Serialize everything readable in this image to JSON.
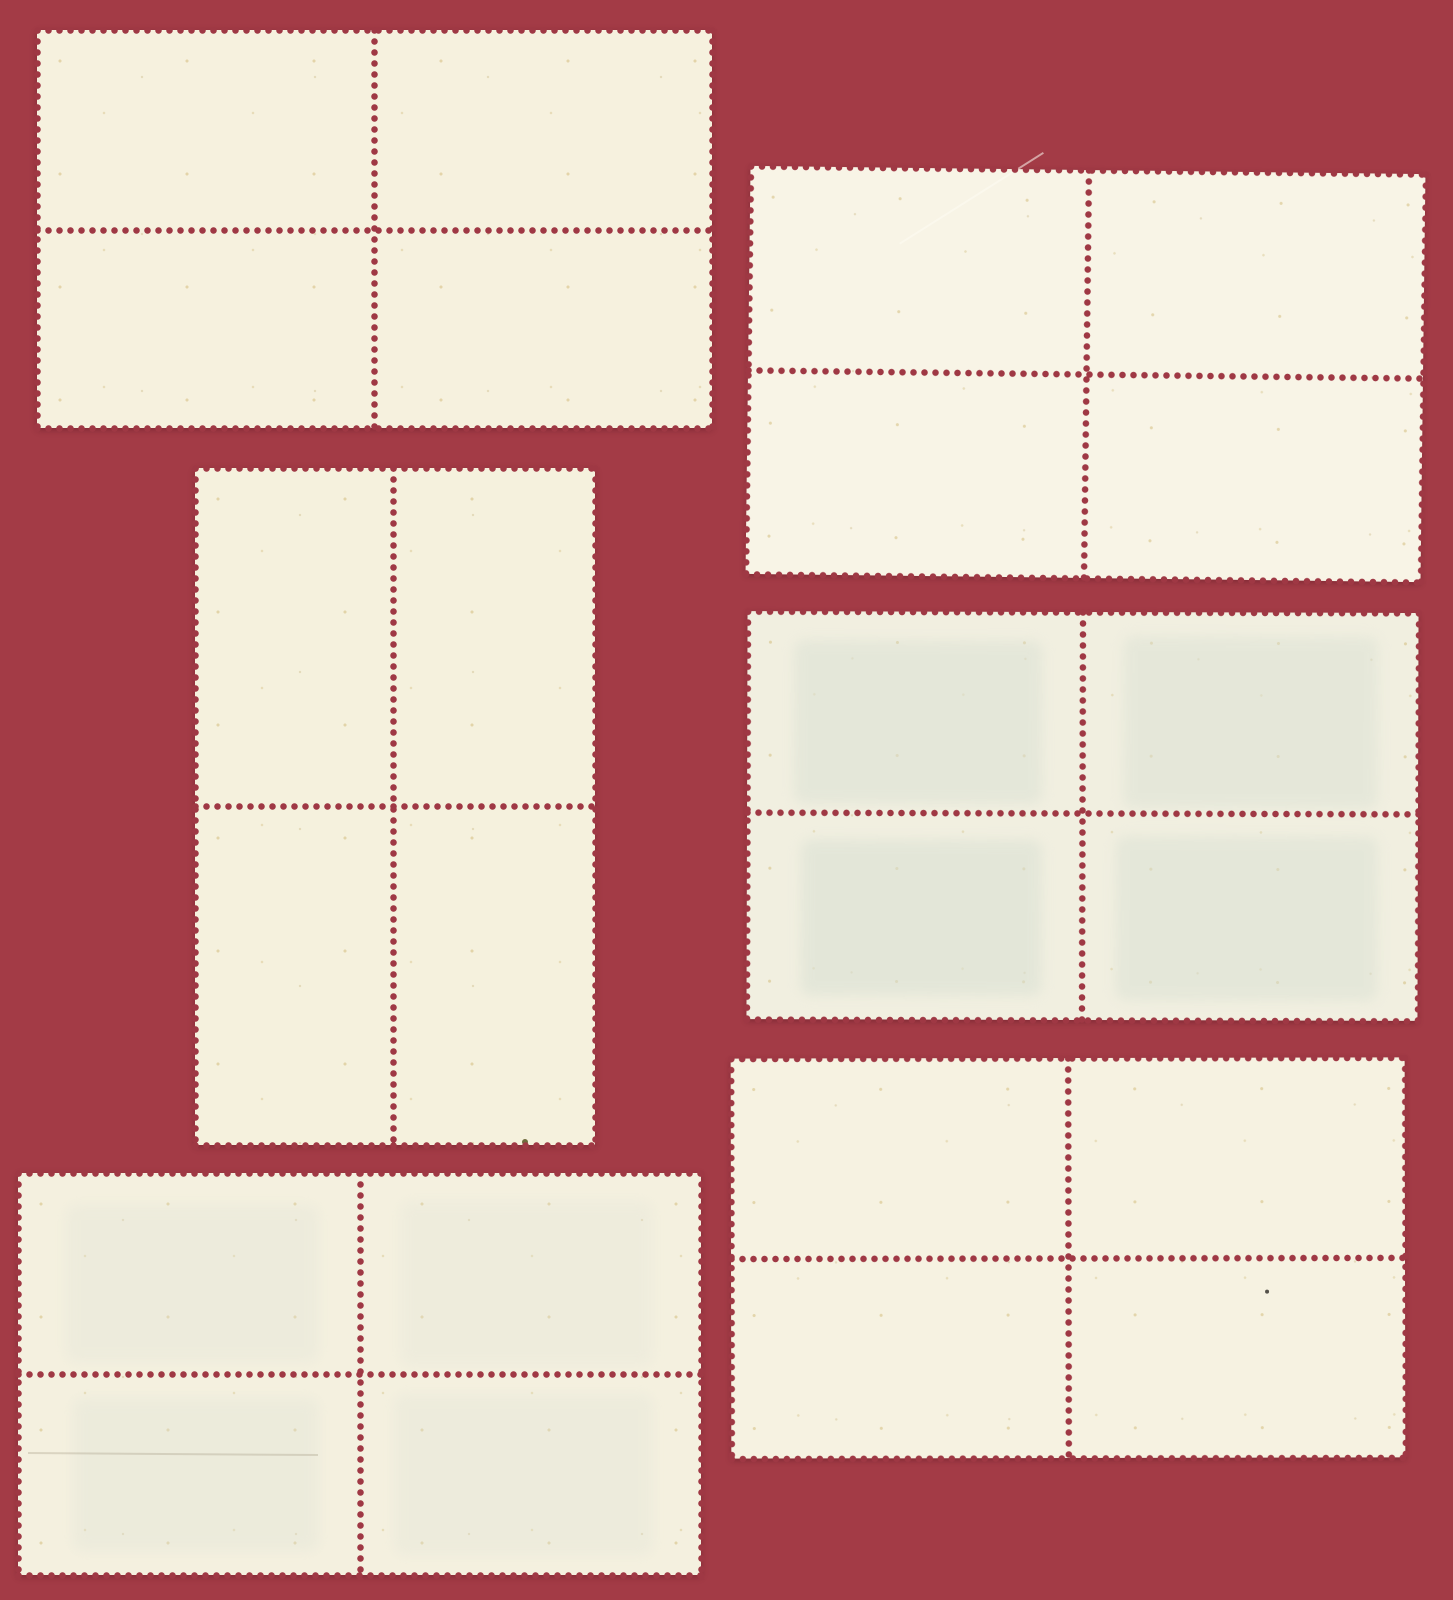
{
  "scene": {
    "type": "scanned-photo",
    "subject": "Six mint postage stamp blocks of four, shown from the blank gummed reverse side, arranged on a dark red album background",
    "canvas": {
      "width": 1453,
      "height": 1600
    },
    "colors": {
      "background_red": "#A33B46",
      "perforation_hole_red": "#9F3844",
      "shadow": "rgba(75,18,28,0.4)"
    },
    "perforation": {
      "pitch_px": 11,
      "hole_diameter_px": 7
    }
  },
  "blocks": [
    {
      "name": "stamp-block-top-left",
      "layout_hint": "horizontal block of four, 2x2",
      "x": 37,
      "y": 30,
      "width": 675,
      "height": 398,
      "vperf": 337,
      "hperf": 200,
      "rotation": 0,
      "paper_color": "#F6F1DE",
      "ghosts": [],
      "details": []
    },
    {
      "name": "stamp-block-top-right",
      "layout_hint": "horizontal block of four, 2x2, slightly tilted",
      "x": 748,
      "y": 170,
      "width": 675,
      "height": 408,
      "vperf": 338,
      "hperf": 204,
      "rotation": 0.7,
      "paper_color": "#F8F4E6",
      "ghosts": [],
      "details": [
        {
          "kind": "scratch",
          "left": 150,
          "top": 75,
          "length": 170,
          "angle": -33,
          "color": "rgba(253,251,243,0.55)"
        }
      ]
    },
    {
      "name": "stamp-block-middle-left",
      "layout_hint": "vertical block of four, 2x2 of upright stamps",
      "x": 195,
      "y": 468,
      "width": 400,
      "height": 677,
      "vperf": 198,
      "hperf": 338,
      "rotation": 0,
      "paper_color": "#F5F1DD",
      "ghosts": [],
      "details": [
        {
          "kind": "speck",
          "left": 327,
          "top": 671,
          "size": 6,
          "color": "#6F6A3D"
        }
      ]
    },
    {
      "name": "stamp-block-middle-right",
      "layout_hint": "horizontal block of four with faint greenish print-through of front design",
      "x": 747,
      "y": 612,
      "width": 671,
      "height": 408,
      "vperf": 335,
      "hperf": 201,
      "rotation": 0.15,
      "paper_color": "#F1EFE0",
      "ghosts": [
        {
          "left": 7,
          "top": 7,
          "width": 37,
          "height": 40,
          "color": "#DBE1D4",
          "opacity": 0.55
        },
        {
          "left": 56,
          "top": 6,
          "width": 38,
          "height": 42,
          "color": "#DBE1D4",
          "opacity": 0.5
        },
        {
          "left": 8,
          "top": 56,
          "width": 36,
          "height": 38,
          "color": "#D9E0D3",
          "opacity": 0.55
        },
        {
          "left": 55,
          "top": 55,
          "width": 39,
          "height": 40,
          "color": "#D9E0D3",
          "opacity": 0.5
        }
      ],
      "details": []
    },
    {
      "name": "stamp-block-bottom-left",
      "layout_hint": "horizontal block of four with very faint print-through and a light crease",
      "x": 18,
      "y": 1173,
      "width": 683,
      "height": 402,
      "vperf": 342,
      "hperf": 201,
      "rotation": 0,
      "paper_color": "#F4F0DF",
      "ghosts": [
        {
          "left": 7,
          "top": 8,
          "width": 37,
          "height": 39,
          "color": "#DFE2D6",
          "opacity": 0.3
        },
        {
          "left": 56,
          "top": 7,
          "width": 37,
          "height": 41,
          "color": "#DFE2D6",
          "opacity": 0.26
        },
        {
          "left": 8,
          "top": 56,
          "width": 36,
          "height": 38,
          "color": "#DDE1D5",
          "opacity": 0.32
        },
        {
          "left": 55,
          "top": 55,
          "width": 38,
          "height": 40,
          "color": "#DDE1D5",
          "opacity": 0.28
        }
      ],
      "details": [
        {
          "kind": "crease",
          "left": 10,
          "top": 279,
          "length": 290,
          "angle": 0.4,
          "color": "rgba(150,140,115,0.28)"
        }
      ]
    },
    {
      "name": "stamp-block-bottom-right",
      "layout_hint": "horizontal block of four, clean back",
      "x": 731,
      "y": 1058,
      "width": 674,
      "height": 400,
      "vperf": 337,
      "hperf": 200,
      "rotation": -0.1,
      "paper_color": "#F6F2E1",
      "ghosts": [],
      "details": [
        {
          "kind": "speck",
          "left": 534,
          "top": 232,
          "size": 4,
          "color": "#55524A"
        }
      ]
    }
  ]
}
